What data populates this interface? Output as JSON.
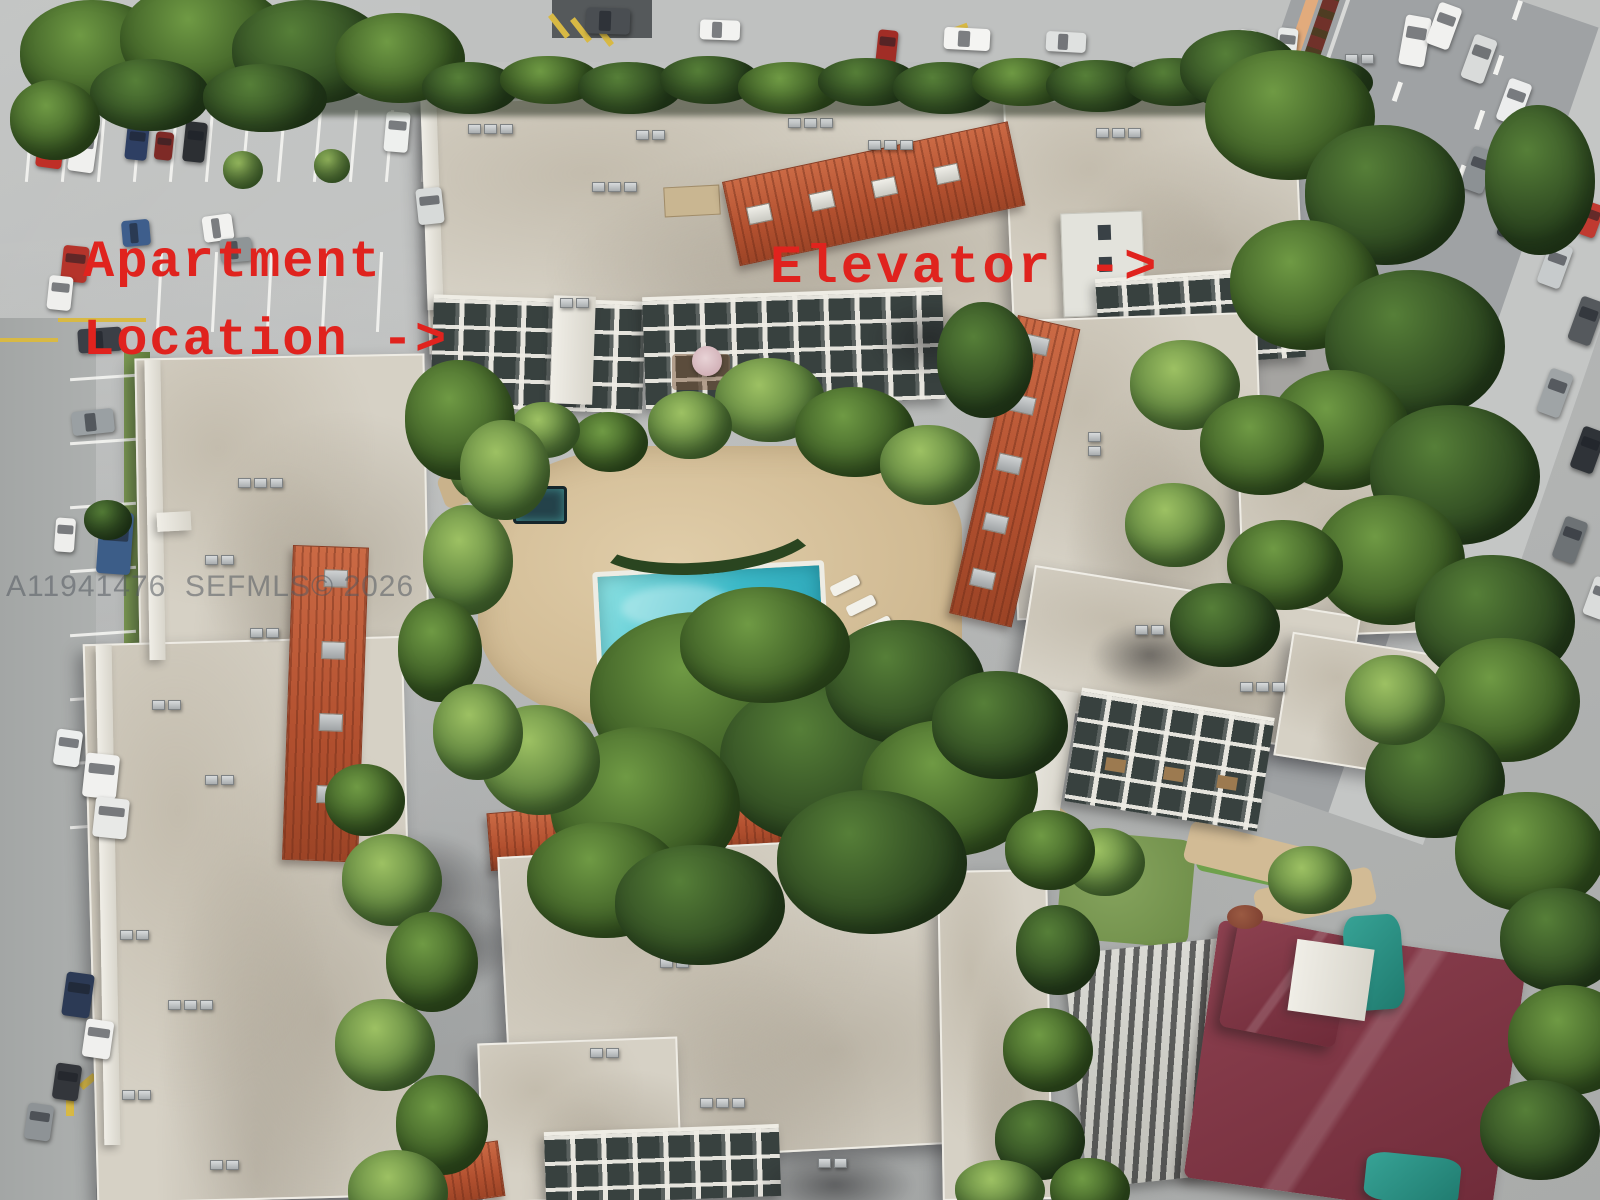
{
  "meta": {
    "title": "Annotated aerial 3D view of an apartment complex with courtyard pool, parking lots and adjacent road"
  },
  "annotations": {
    "apartment_line1": "Apartment",
    "apartment_line2": "Location ->",
    "elevator": "Elevator ->",
    "color": "#e0231e"
  },
  "watermark": {
    "text": "A11941476  SEFMLS© 2026",
    "color": "rgba(84,89,96,0.55)"
  },
  "palette": {
    "pavement": "#b4b6b5",
    "road": "#9fa2a4",
    "roof_beige": "#d6d1c5",
    "red_tile": "#b2502f",
    "maroon_roof": "#7d3140",
    "tree_dark": "#2f4a25",
    "tree_light": "#7ba348",
    "pool_water": "#3cbac9",
    "pool_light": "#8fe3e4",
    "pool_deck": "#d7c19c",
    "teal_tarp": "#2f9488",
    "yellow_marking": "#d8b944",
    "grass": "#7d9b58"
  },
  "scene": {
    "features": [
      "apartment-buildings",
      "courtyard-swimming-pool",
      "pool-deck",
      "parking-lot",
      "street-with-traffic",
      "tree-canopy",
      "red-tile-roofs",
      "maroon-roof-house",
      "elevator-tower"
    ],
    "trees": [
      [
        95,
        55,
        75,
        55,
        1
      ],
      [
        205,
        40,
        85,
        58,
        1
      ],
      [
        310,
        52,
        78,
        52,
        0
      ],
      [
        400,
        58,
        65,
        45,
        1
      ],
      [
        150,
        95,
        60,
        36,
        0
      ],
      [
        265,
        98,
        62,
        34,
        0
      ],
      [
        55,
        120,
        45,
        40,
        1
      ],
      [
        470,
        88,
        48,
        26,
        0
      ],
      [
        550,
        80,
        50,
        24,
        1
      ],
      [
        630,
        88,
        52,
        26,
        0
      ],
      [
        710,
        80,
        50,
        24,
        0
      ],
      [
        790,
        88,
        52,
        26,
        1
      ],
      [
        868,
        82,
        50,
        24,
        0
      ],
      [
        945,
        88,
        52,
        26,
        0
      ],
      [
        1022,
        82,
        50,
        24,
        1
      ],
      [
        1098,
        86,
        52,
        26,
        0
      ],
      [
        1175,
        82,
        50,
        24,
        0
      ],
      [
        1252,
        88,
        52,
        26,
        1
      ],
      [
        1325,
        82,
        48,
        24,
        0
      ],
      [
        1240,
        70,
        60,
        40,
        0
      ],
      [
        243,
        170,
        20,
        19,
        2
      ],
      [
        332,
        166,
        18,
        17,
        2
      ],
      [
        108,
        520,
        24,
        20,
        0
      ],
      [
        1290,
        115,
        85,
        65,
        1
      ],
      [
        1385,
        195,
        80,
        70,
        0
      ],
      [
        1305,
        285,
        75,
        65,
        1
      ],
      [
        1415,
        345,
        90,
        75,
        0
      ],
      [
        1340,
        430,
        70,
        60,
        1
      ],
      [
        1455,
        475,
        85,
        70,
        0
      ],
      [
        1390,
        560,
        75,
        65,
        1
      ],
      [
        1495,
        620,
        80,
        65,
        0
      ],
      [
        1540,
        180,
        55,
        75,
        0
      ],
      [
        985,
        360,
        48,
        58,
        0
      ],
      [
        770,
        400,
        55,
        42,
        2
      ],
      [
        855,
        432,
        60,
        45,
        1
      ],
      [
        930,
        465,
        50,
        40,
        2
      ],
      [
        690,
        425,
        42,
        34,
        2
      ],
      [
        610,
        442,
        38,
        30,
        1
      ],
      [
        545,
        430,
        35,
        28,
        2
      ],
      [
        478,
        462,
        30,
        38,
        2
      ],
      [
        705,
        700,
        115,
        88,
        1
      ],
      [
        825,
        762,
        105,
        82,
        0
      ],
      [
        645,
        805,
        95,
        78,
        1
      ],
      [
        905,
        682,
        80,
        62,
        0
      ],
      [
        765,
        645,
        85,
        58,
        1
      ],
      [
        950,
        788,
        88,
        68,
        1
      ],
      [
        872,
        862,
        95,
        72,
        0
      ],
      [
        605,
        880,
        78,
        58,
        1
      ],
      [
        1000,
        725,
        68,
        54,
        0
      ],
      [
        540,
        760,
        60,
        55,
        2
      ],
      [
        700,
        905,
        85,
        60,
        0
      ],
      [
        468,
        560,
        45,
        55,
        2
      ],
      [
        440,
        650,
        42,
        52,
        1
      ],
      [
        478,
        732,
        45,
        48,
        2
      ],
      [
        460,
        420,
        55,
        60,
        1
      ],
      [
        505,
        470,
        45,
        50,
        2
      ],
      [
        1185,
        385,
        55,
        45,
        2
      ],
      [
        1262,
        445,
        62,
        50,
        1
      ],
      [
        1175,
        525,
        50,
        42,
        2
      ],
      [
        1285,
        565,
        58,
        45,
        1
      ],
      [
        1225,
        625,
        55,
        42,
        0
      ],
      [
        1505,
        700,
        75,
        62,
        1
      ],
      [
        1435,
        780,
        70,
        58,
        0
      ],
      [
        1530,
        852,
        75,
        60,
        1
      ],
      [
        1560,
        940,
        60,
        52,
        0
      ],
      [
        1570,
        1040,
        62,
        55,
        1
      ],
      [
        1540,
        1130,
        60,
        50,
        0
      ],
      [
        1310,
        880,
        42,
        34,
        2
      ],
      [
        1105,
        862,
        40,
        34,
        2
      ],
      [
        392,
        880,
        50,
        46,
        2
      ],
      [
        432,
        962,
        46,
        50,
        1
      ],
      [
        385,
        1045,
        50,
        46,
        2
      ],
      [
        442,
        1125,
        46,
        50,
        1
      ],
      [
        398,
        1192,
        50,
        42,
        2
      ],
      [
        365,
        800,
        40,
        36,
        1
      ],
      [
        1050,
        850,
        45,
        40,
        1
      ],
      [
        1058,
        950,
        42,
        45,
        0
      ],
      [
        1048,
        1050,
        45,
        42,
        1
      ],
      [
        1040,
        1140,
        45,
        40,
        0
      ],
      [
        1090,
        1190,
        40,
        32,
        1
      ],
      [
        1000,
        1190,
        45,
        30,
        2
      ],
      [
        1395,
        700,
        50,
        45,
        2
      ]
    ],
    "cars": [
      [
        38,
        122,
        26,
        46,
        8,
        "#bf2f27"
      ],
      [
        70,
        128,
        26,
        44,
        8,
        "#f0f0ee"
      ],
      [
        126,
        124,
        22,
        36,
        6,
        "#2e3f63"
      ],
      [
        155,
        132,
        18,
        28,
        6,
        "#7e2a26"
      ],
      [
        184,
        122,
        22,
        40,
        6,
        "#2c2f33"
      ],
      [
        385,
        112,
        24,
        40,
        5,
        "#eef0ee"
      ],
      [
        417,
        188,
        26,
        36,
        -6,
        "#d7dad9"
      ],
      [
        203,
        215,
        30,
        26,
        -8,
        "#f2f2f0"
      ],
      [
        220,
        238,
        32,
        24,
        -5,
        "#8f9597"
      ],
      [
        62,
        246,
        26,
        36,
        6,
        "#b5342b"
      ],
      [
        48,
        276,
        24,
        34,
        6,
        "#efefed"
      ],
      [
        122,
        220,
        28,
        26,
        -5,
        "#3e5e8c"
      ],
      [
        78,
        328,
        44,
        24,
        -4,
        "#3b3f46"
      ],
      [
        72,
        410,
        42,
        24,
        -6,
        "#9aa0a3"
      ],
      [
        98,
        512,
        34,
        62,
        4,
        "#3c5d88"
      ],
      [
        55,
        518,
        20,
        34,
        4,
        "#eeeeec"
      ],
      [
        84,
        754,
        34,
        44,
        6,
        "#f1f1ef"
      ],
      [
        94,
        798,
        34,
        40,
        6,
        "#e8e9e7"
      ],
      [
        55,
        730,
        26,
        36,
        8,
        "#eceeed"
      ],
      [
        64,
        973,
        28,
        44,
        8,
        "#2c3a55"
      ],
      [
        84,
        1020,
        28,
        38,
        8,
        "#f0f0ee"
      ],
      [
        54,
        1064,
        26,
        36,
        8,
        "#33363b"
      ],
      [
        26,
        1104,
        26,
        36,
        8,
        "#8e9396"
      ],
      [
        586,
        8,
        44,
        26,
        2,
        "#4a4e52"
      ],
      [
        700,
        20,
        40,
        20,
        2,
        "#f2f2f0"
      ],
      [
        877,
        30,
        20,
        34,
        6,
        "#a12d26"
      ],
      [
        944,
        28,
        46,
        22,
        3,
        "#f4f4f2"
      ],
      [
        1046,
        32,
        40,
        20,
        3,
        "#dfe1e0"
      ],
      [
        1237,
        30,
        20,
        34,
        6,
        "#f2f2f0"
      ],
      [
        1277,
        28,
        20,
        34,
        6,
        "#e8eae9"
      ],
      [
        1402,
        16,
        26,
        50,
        10,
        "#f1f1ef"
      ],
      [
        1432,
        4,
        24,
        44,
        20,
        "#f1f1ef"
      ],
      [
        1467,
        36,
        24,
        46,
        20,
        "#d9dbda"
      ],
      [
        1502,
        80,
        24,
        44,
        20,
        "#eceded"
      ],
      [
        1538,
        126,
        24,
        46,
        20,
        "#aab0b2"
      ],
      [
        1466,
        148,
        24,
        44,
        20,
        "#8c9194"
      ],
      [
        1503,
        194,
        24,
        46,
        20,
        "#3a3f43"
      ],
      [
        1543,
        243,
        24,
        44,
        20,
        "#c7cbcc"
      ],
      [
        1574,
        298,
        24,
        46,
        20,
        "#55595d"
      ],
      [
        1582,
        203,
        18,
        34,
        20,
        "#c03a30"
      ],
      [
        1543,
        370,
        24,
        46,
        20,
        "#9fa4a6"
      ],
      [
        1576,
        428,
        24,
        44,
        20,
        "#2f3338"
      ],
      [
        1558,
        518,
        24,
        44,
        20,
        "#6d7275"
      ],
      [
        1588,
        578,
        22,
        40,
        20,
        "#dadcdb"
      ]
    ],
    "ac_units": [
      [
        468,
        124,
        3,
        "h"
      ],
      [
        592,
        182,
        3,
        "h"
      ],
      [
        636,
        130,
        2,
        "h"
      ],
      [
        788,
        118,
        3,
        "h"
      ],
      [
        868,
        140,
        3,
        "h"
      ],
      [
        940,
        96,
        2,
        "h"
      ],
      [
        560,
        298,
        2,
        "h"
      ],
      [
        1096,
        128,
        3,
        "h"
      ],
      [
        1180,
        62,
        2,
        "h"
      ],
      [
        1262,
        148,
        3,
        "h"
      ],
      [
        1345,
        54,
        2,
        "h"
      ],
      [
        1150,
        352,
        2,
        "h"
      ],
      [
        1210,
        396,
        3,
        "v"
      ],
      [
        1300,
        470,
        2,
        "h"
      ],
      [
        1088,
        432,
        2,
        "v"
      ],
      [
        1258,
        556,
        3,
        "h"
      ],
      [
        1135,
        625,
        2,
        "h"
      ],
      [
        1240,
        682,
        3,
        "h"
      ],
      [
        238,
        478,
        3,
        "h"
      ],
      [
        205,
        555,
        2,
        "h"
      ],
      [
        250,
        628,
        2,
        "h"
      ],
      [
        152,
        700,
        2,
        "h"
      ],
      [
        205,
        775,
        2,
        "h"
      ],
      [
        120,
        930,
        2,
        "h"
      ],
      [
        168,
        1000,
        3,
        "h"
      ],
      [
        122,
        1090,
        2,
        "h"
      ],
      [
        210,
        1160,
        2,
        "h"
      ],
      [
        560,
        772,
        2,
        "h"
      ],
      [
        640,
        760,
        3,
        "h"
      ],
      [
        758,
        750,
        2,
        "h"
      ],
      [
        848,
        744,
        3,
        "h"
      ],
      [
        928,
        740,
        2,
        "h"
      ],
      [
        585,
        900,
        3,
        "h"
      ],
      [
        660,
        958,
        2,
        "h"
      ],
      [
        590,
        1048,
        2,
        "h"
      ],
      [
        700,
        1098,
        3,
        "h"
      ],
      [
        818,
        1158,
        2,
        "h"
      ],
      [
        1015,
        1160,
        2,
        "h"
      ],
      [
        1205,
        618,
        2,
        "h"
      ]
    ],
    "stall_rows": [
      {
        "x": 28,
        "y": 110,
        "step": 36,
        "n": 12,
        "len": 72,
        "r": 5,
        "o": "v"
      },
      {
        "x": 158,
        "y": 252,
        "step": 55,
        "n": 6,
        "len": 80,
        "r": 3,
        "o": "v"
      },
      {
        "x": 70,
        "y": 376,
        "step": 64,
        "n": 8,
        "len": 66,
        "r": -4,
        "o": "h"
      }
    ],
    "marks": [
      [
        58,
        318,
        88,
        4,
        0,
        "y"
      ],
      [
        0,
        338,
        58,
        4,
        0,
        "y"
      ],
      [
        556,
        12,
        6,
        28,
        -38,
        "y"
      ],
      [
        578,
        16,
        6,
        28,
        -38,
        "y"
      ],
      [
        600,
        20,
        6,
        28,
        -38,
        "y"
      ],
      [
        948,
        26,
        20,
        5,
        -20,
        "y"
      ],
      [
        100,
        688,
        46,
        5,
        -52,
        "b"
      ],
      [
        112,
        698,
        46,
        5,
        -52,
        "b"
      ],
      [
        66,
        1086,
        8,
        30,
        0,
        "y"
      ],
      [
        57,
        1078,
        18,
        7,
        40,
        "y"
      ],
      [
        79,
        1078,
        18,
        7,
        -40,
        "y"
      ]
    ]
  }
}
